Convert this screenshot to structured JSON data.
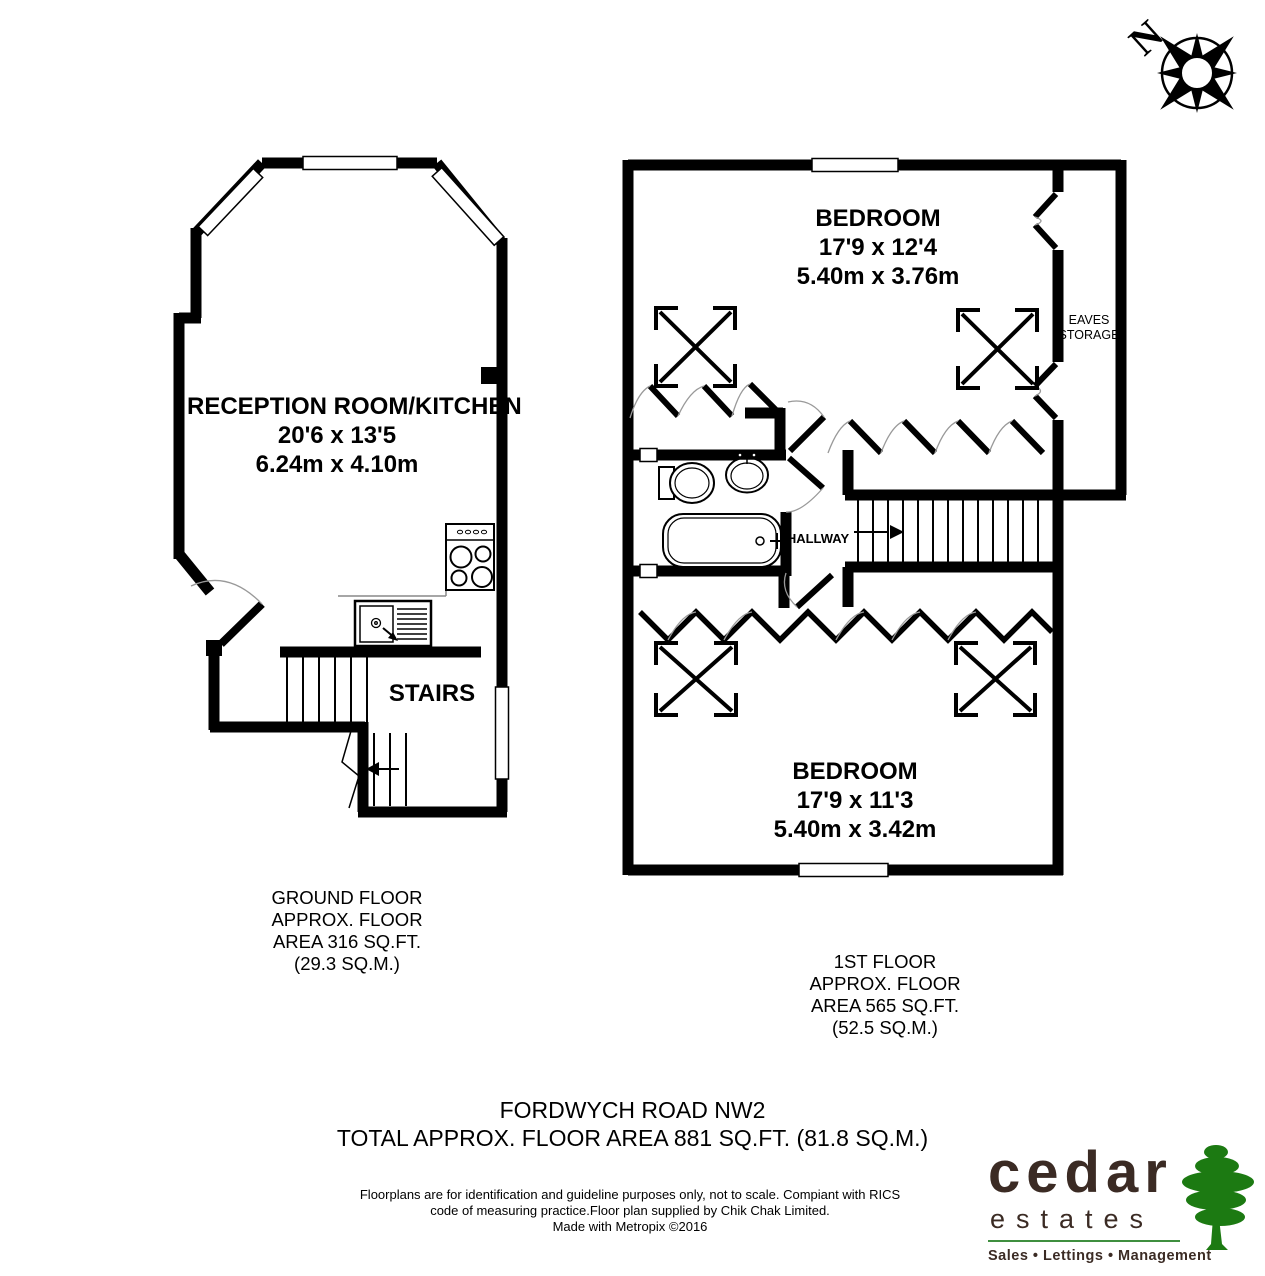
{
  "compass": {
    "north_label": "N"
  },
  "ground_floor": {
    "reception": {
      "name": "RECEPTION ROOM/KITCHEN",
      "size_imperial": "20'6 x 13'5",
      "size_metric": "6.24m x 4.10m"
    },
    "stairs_label": "STAIRS",
    "caption": [
      "GROUND FLOOR",
      "APPROX. FLOOR",
      "AREA 316 SQ.FT.",
      "(29.3 SQ.M.)"
    ]
  },
  "first_floor": {
    "bedroom_top": {
      "name": "BEDROOM",
      "size_imperial": "17'9 x 12'4",
      "size_metric": "5.40m x 3.76m"
    },
    "bedroom_bottom": {
      "name": "BEDROOM",
      "size_imperial": "17'9 x 11'3",
      "size_metric": "5.40m x 3.42m"
    },
    "eaves_storage": [
      "EAVES",
      "STORAGE"
    ],
    "hallway_label": "HALLWAY",
    "caption": [
      "1ST FLOOR",
      "APPROX. FLOOR",
      "AREA 565 SQ.FT.",
      "(52.5 SQ.M.)"
    ]
  },
  "footer": {
    "address": "FORDWYCH ROAD NW2",
    "total": "TOTAL APPROX. FLOOR AREA 881 SQ.FT. (81.8 SQ.M.)",
    "disclaimer": [
      "Floorplans are for identification and guideline purposes only, not to scale. Compiant with RICS",
      "code of measuring practice.Floor plan supplied by Chik Chak Limited.",
      "Made with Metropix ©2016"
    ]
  },
  "logo": {
    "brand": "cedar",
    "brand_sub": "estates",
    "tagline": "Sales • Lettings • Management",
    "colors": {
      "brand_brown": "#3b2b24",
      "tree_green": "#1c7a12",
      "rule_green": "#3f8f3f",
      "wall_black": "#000000"
    }
  }
}
